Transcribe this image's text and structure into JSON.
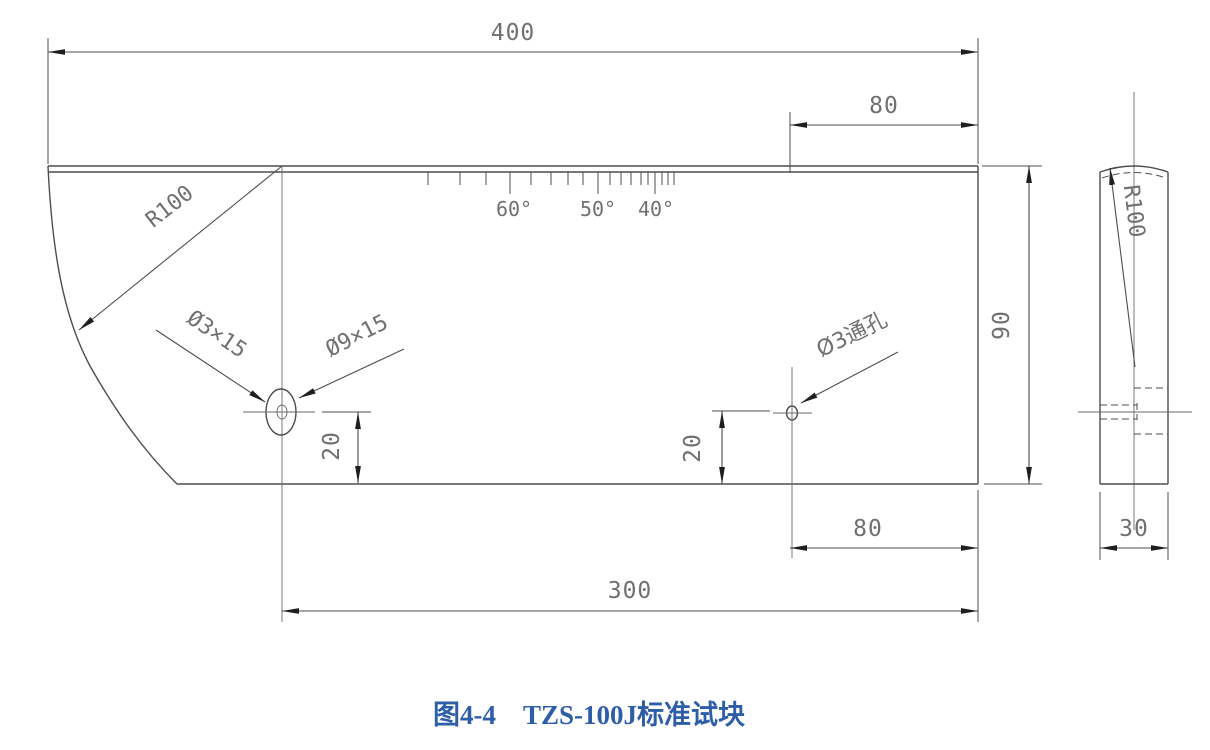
{
  "drawing": {
    "caption": "图4-4　TZS-100J标准试块",
    "dims": {
      "length": "400",
      "top_offset": "80",
      "height": "90",
      "left_hole_elev": "20",
      "right_hole_elev": "20",
      "bottom_offset": "80",
      "span": "300",
      "thickness": "30"
    },
    "labels": {
      "front_radius": "R100",
      "side_radius": "R100",
      "small_hole": "Ø3×15",
      "large_hole": "Ø9×15",
      "through_hole": "Ø3通孔"
    },
    "angle_scale": {
      "labels": [
        "60°",
        "50°",
        "40°"
      ],
      "tick_x": [
        428,
        460,
        486,
        510,
        531,
        551,
        568,
        583,
        598,
        610,
        621,
        631,
        641,
        648,
        655,
        662,
        668,
        674
      ],
      "long_tick_x": [
        510,
        598,
        655
      ],
      "tick_top_y": 172,
      "short_len": 13,
      "long_len": 22
    }
  },
  "colors": {
    "line": "#4d4d4d",
    "text": "#707070",
    "arrow": "#1f1f1f",
    "caption_blue": "#2f5ea8",
    "background": "#ffffff"
  }
}
